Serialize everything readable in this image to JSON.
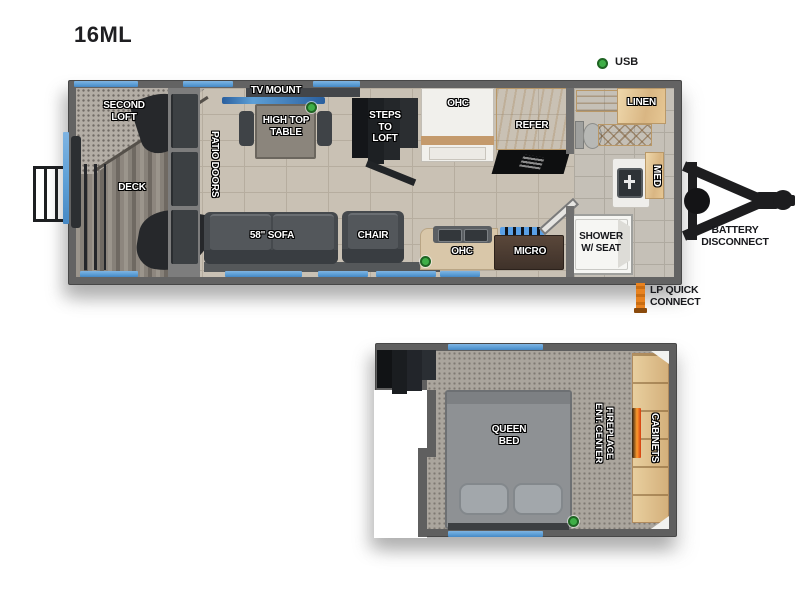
{
  "title": "16ML",
  "legend": {
    "usb_label": "USB"
  },
  "main_floor": {
    "labels": {
      "second_loft": "SECOND\nLOFT",
      "deck": "DECK",
      "patio_doors": "PATIO DOORS",
      "tv_mount": "TV MOUNT",
      "high_top_table": "HIGH TOP\nTABLE",
      "steps_to_loft": "STEPS\nTO\nLOFT",
      "ohc_top": "OHC",
      "refer": "REFER",
      "linen": "LINEN",
      "med": "MED",
      "sofa": "58\" SOFA",
      "chair": "CHAIR",
      "ohc_bottom": "OHC",
      "micro": "MICRO",
      "shower": "SHOWER\nW/ SEAT"
    },
    "callouts": {
      "battery": "BATTERY\nDISCONNECT",
      "lp": "LP QUICK\nCONNECT"
    }
  },
  "loft_floor": {
    "labels": {
      "queen_bed": "QUEEN\nBED",
      "ent_center_fireplace": "ENT. CENTER\nFIREPLACE",
      "cabinets": "CABINETS"
    }
  },
  "colors": {
    "accent_blue": "#5d9fd6",
    "usb_green": "#3fae47",
    "lp_orange": "#e07a1f",
    "wood": "#e3c69b",
    "wall_gray": "#636363"
  }
}
